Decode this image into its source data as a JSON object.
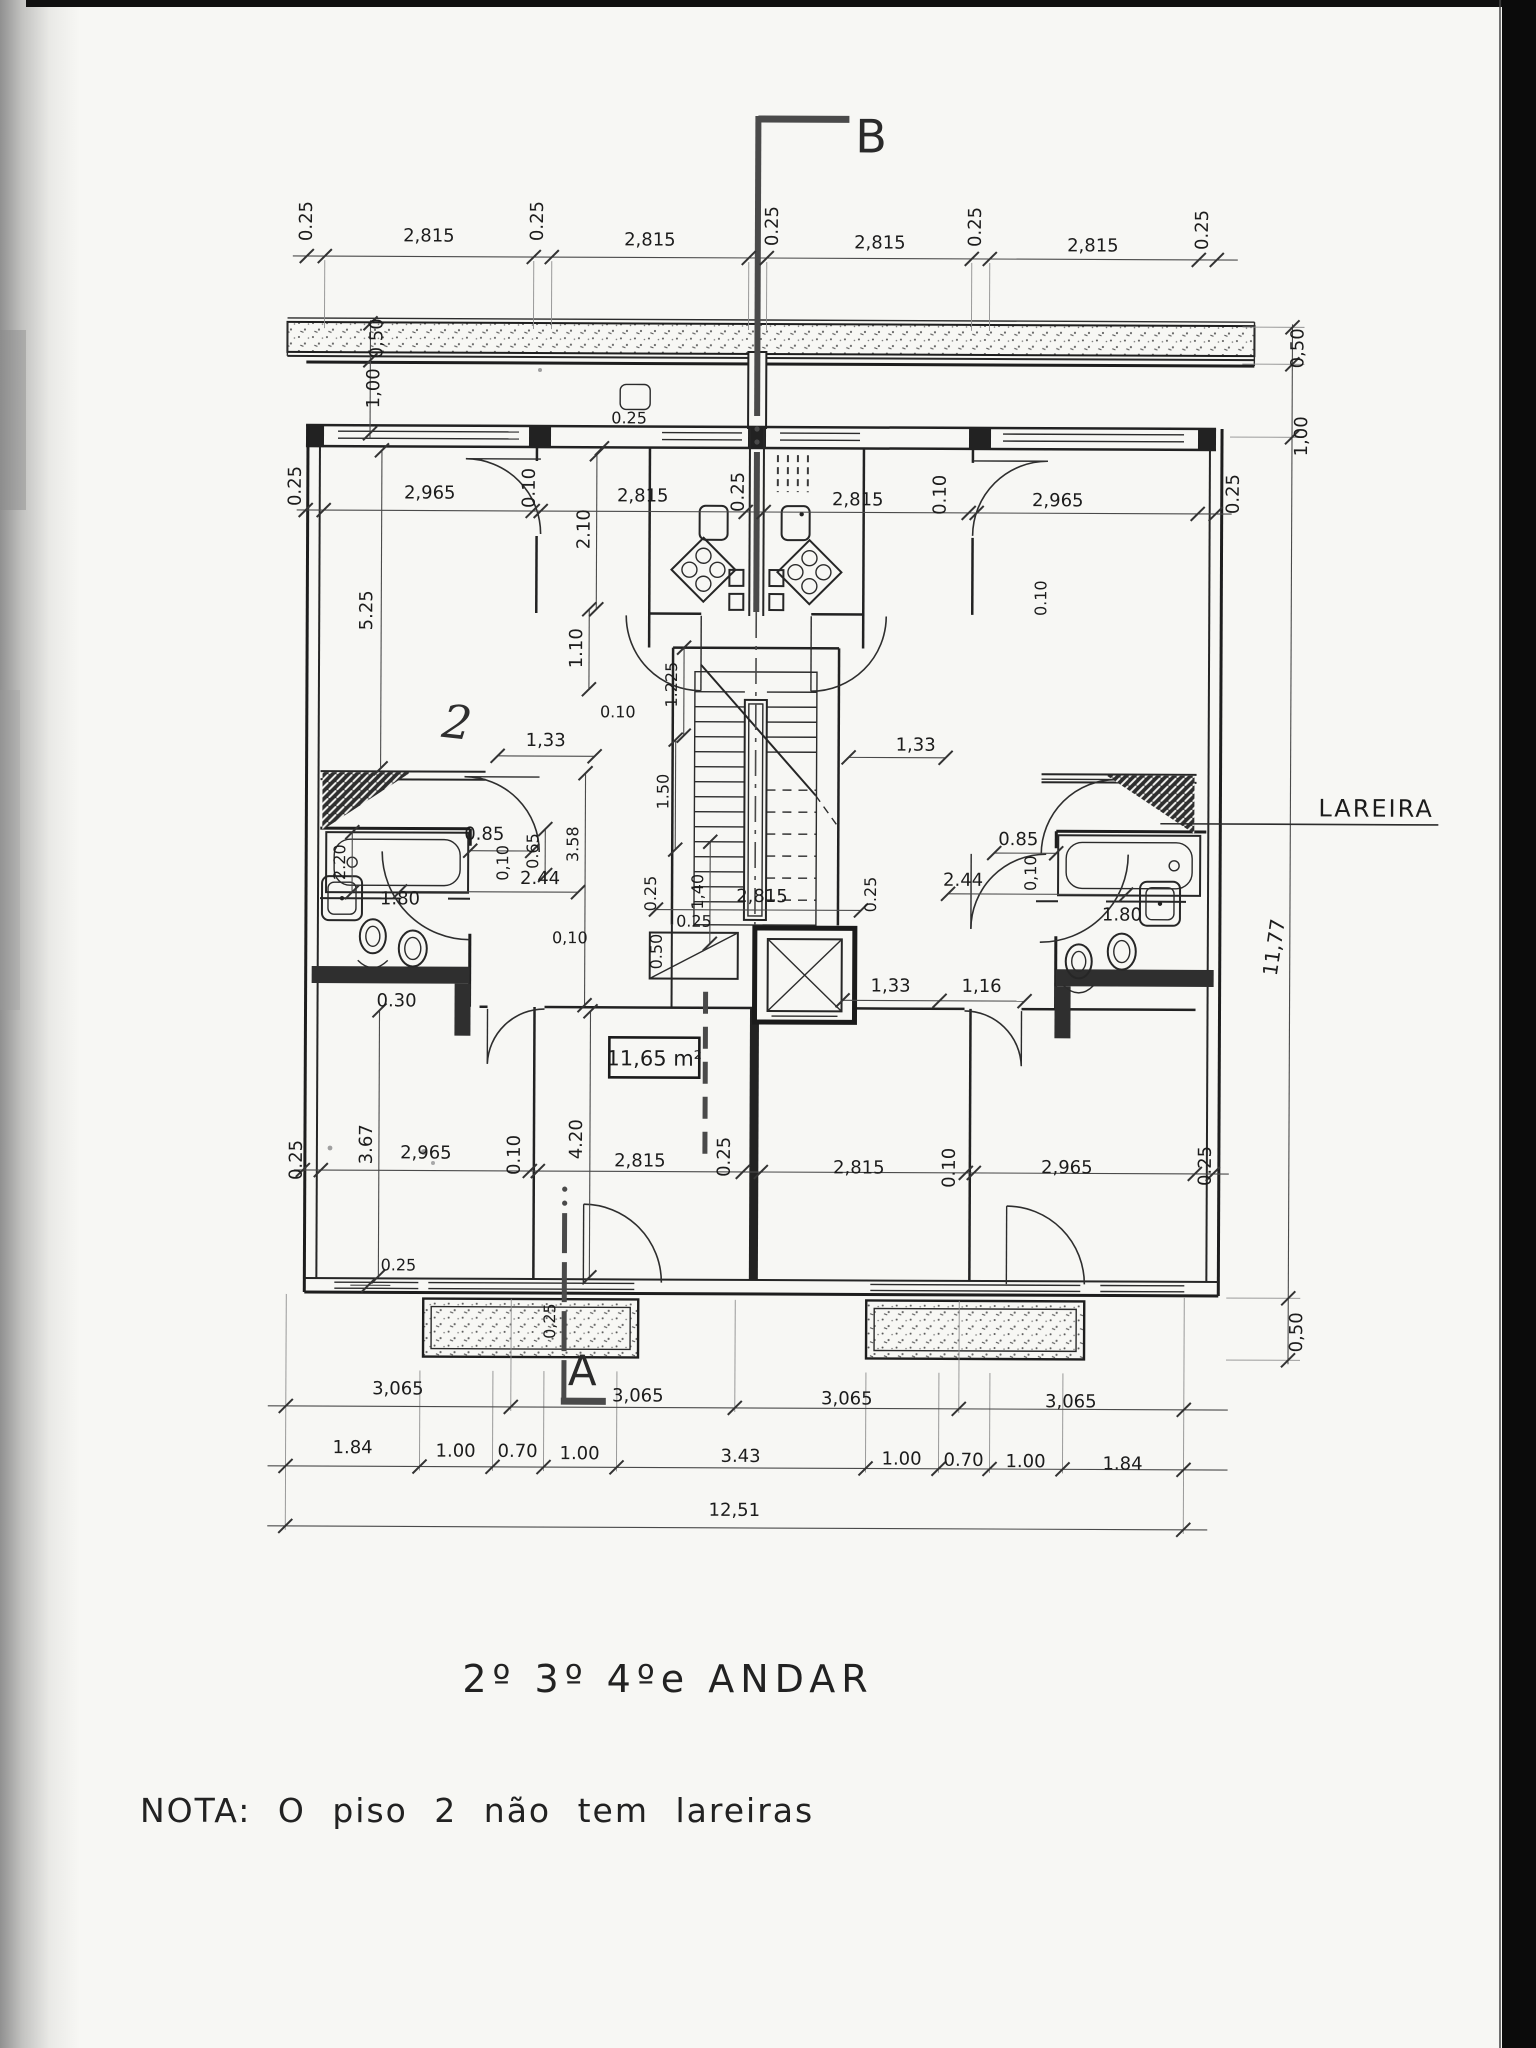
{
  "document": {
    "type": "scanned architectural floor plan",
    "floor_title": "2º 3º 4ºe ANDAR",
    "note": "NOTA: O piso 2 não tem lareiras",
    "fireplace_label": "LAREIRA",
    "area_label": "11,65 m²",
    "handwritten_mark": "2",
    "section_a": "A",
    "section_b": "B"
  },
  "dimensions": {
    "top_chain": [
      "0.25",
      "2,815",
      "0.25",
      "2,815",
      "0.25",
      "2,815",
      "0.25",
      "2,815",
      "0.25"
    ],
    "upper_room_chain": [
      "0.25",
      "2,965",
      "0.10",
      "2,815",
      "0.25",
      "2,815",
      "0.10",
      "2,965",
      "0.25"
    ],
    "lower_room_chain": [
      "0.25",
      "2,965",
      "0.10",
      "2,815",
      "0.25",
      "2,815",
      "0.10",
      "2,965",
      "0.25"
    ],
    "axis_chain": [
      "3,065",
      "3,065",
      "3,065",
      "3,065"
    ],
    "opening_chain": [
      "1.84",
      "1.00",
      "0.70",
      "1.00",
      "3.43",
      "1.00",
      "0.70",
      "1.00",
      "1.84"
    ],
    "overall_width": "12,51",
    "left": {
      "balcony": "0,50",
      "setback": "1,00",
      "living_depth": "5.25",
      "bathtub": "2.20",
      "rear_room": "3.67",
      "wall": "0.25"
    },
    "right": {
      "balcony": "0,50",
      "setback": "1,00",
      "total_depth": "11,77",
      "rear_balcony": "0,50",
      "hall_wall": "0.10"
    },
    "interior": {
      "wall_top_center": "0.25",
      "kitchen_depth": "2.10",
      "hall_entry": "1.10",
      "hall_width_left": "1,33",
      "hall_width_right": "1,33",
      "stair_flight": "1.225",
      "stair_well": "1.50",
      "hall_length": "3.58",
      "landing": "1,40",
      "stair_width": "2,815",
      "stair_wall_left": "0.25",
      "stair_wall_right": "0.25",
      "bath_entry_left": "2.44",
      "bath_entry_right": "2.44",
      "bath_door_left": "0.85",
      "bath_door_right": "0.85",
      "bath_niche": "0.65",
      "bath_wall_left": "0,10",
      "bath_wall_right": "0,10",
      "bath_width_left": "1.80",
      "bath_width_right": "1.80",
      "bath_rear": "0.30",
      "corridor_wall": "0,10",
      "hall_corner_wall": "0.10",
      "lobby_left": "1,33",
      "lobby_right": "1,16",
      "duct": "0.50",
      "duct_wall": "0.25",
      "rear_room_depth": "4.20",
      "balcony_door_wall": "0.25",
      "section_wall": "0,25"
    }
  }
}
